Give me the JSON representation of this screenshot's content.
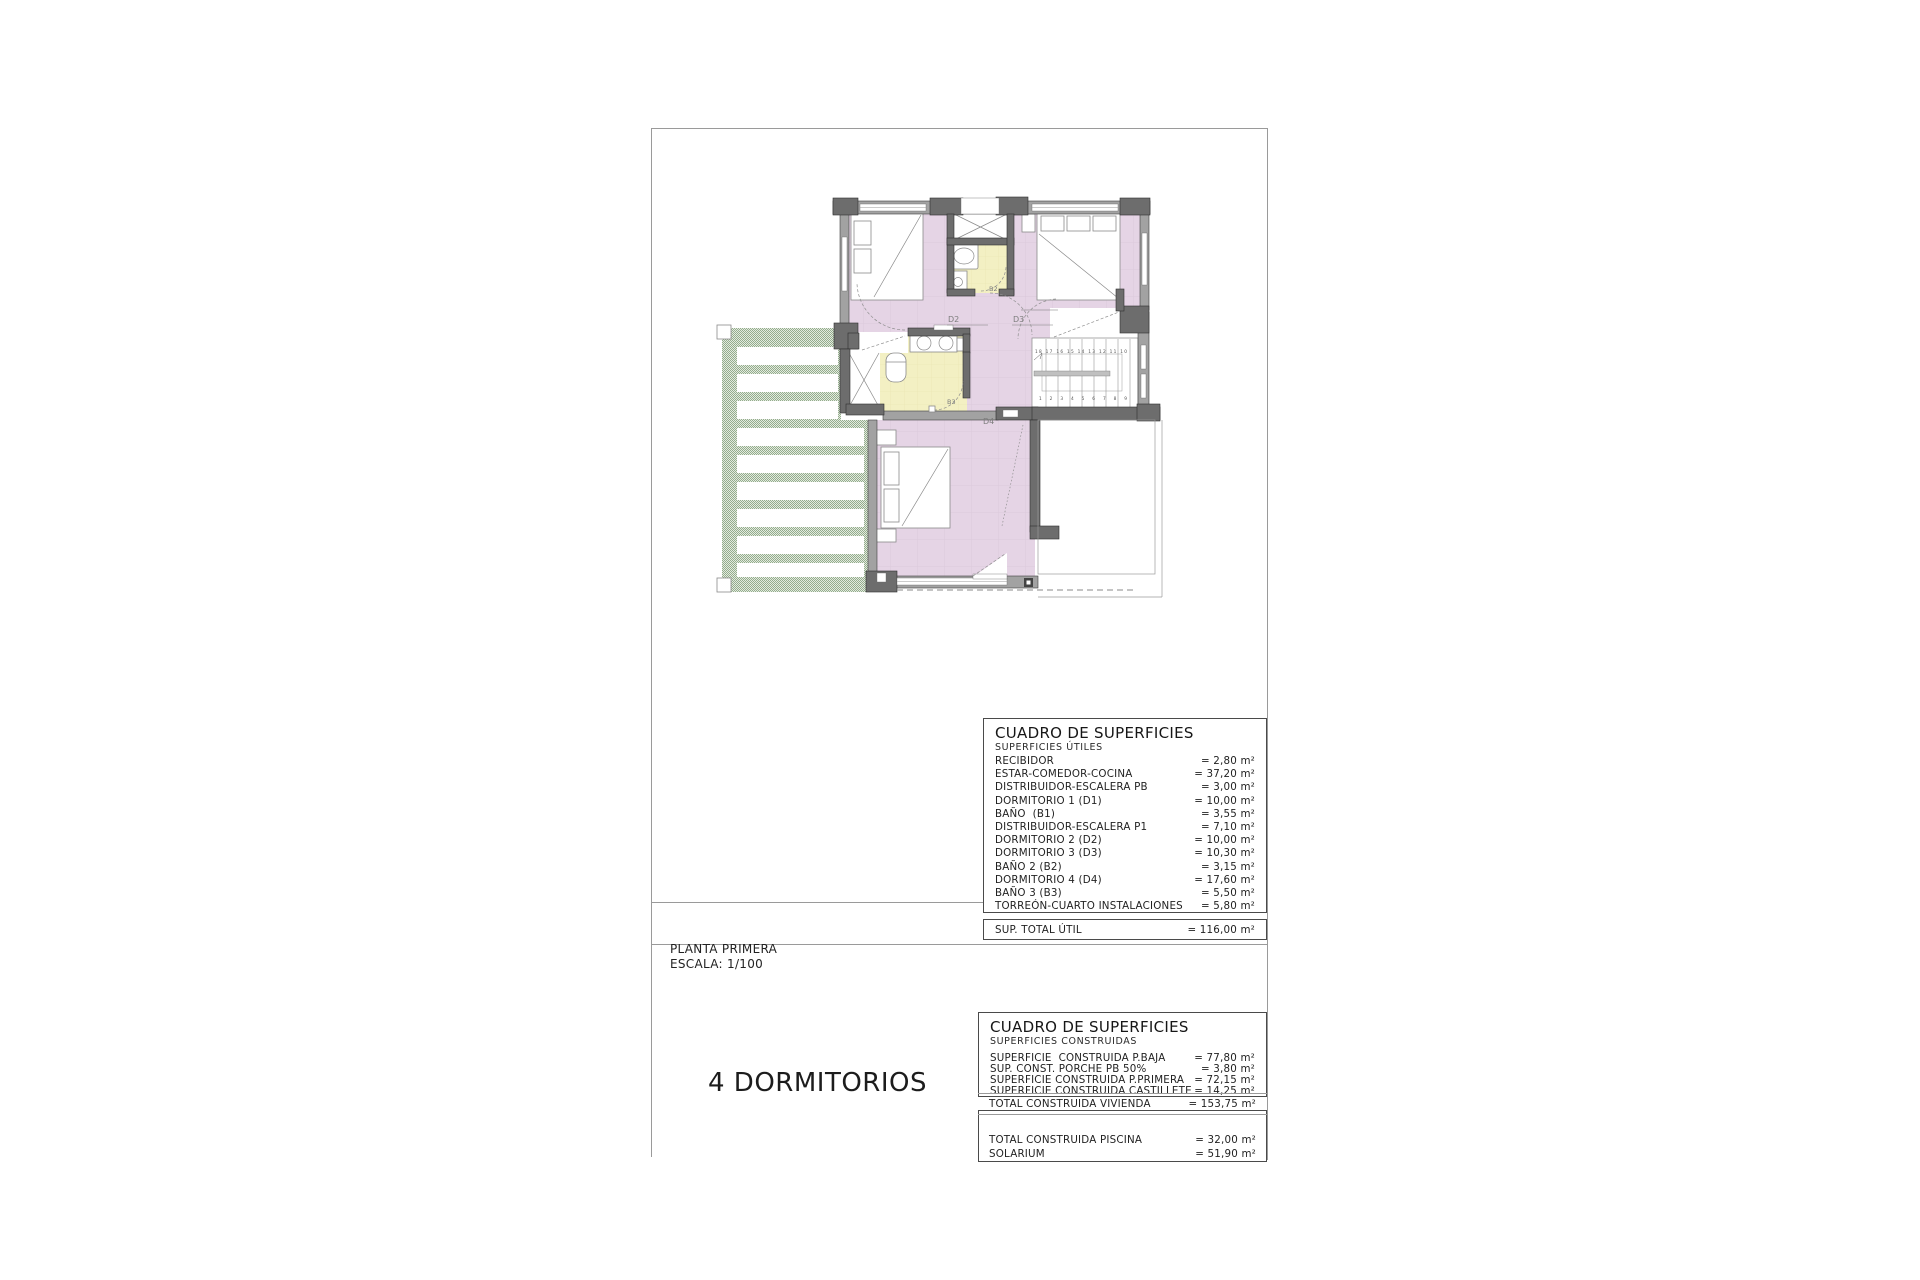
{
  "sheet": {
    "plan_title": "PLANTA PRIMERA",
    "plan_scale": "ESCALA: 1/100",
    "caption": "4 DORMITORIOS"
  },
  "tables": {
    "utiles": {
      "title": "CUADRO DE SUPERFICIES",
      "subtitle": "SUPERFICIES ÚTILES",
      "rows": [
        {
          "label": "RECIBIDOR",
          "value": "= 2,80 m²"
        },
        {
          "label": "ESTAR-COMEDOR-COCINA",
          "value": "= 37,20 m²"
        },
        {
          "label": "DISTRIBUIDOR-ESCALERA PB",
          "value": "= 3,00 m²"
        },
        {
          "label": "DORMITORIO 1 (D1)",
          "value": "= 10,00 m²"
        },
        {
          "label": "BAÑO  (B1)",
          "value": "= 3,55 m²"
        },
        {
          "label": "DISTRIBUIDOR-ESCALERA P1",
          "value": "= 7,10 m²"
        },
        {
          "label": "DORMITORIO 2 (D2)",
          "value": "= 10,00 m²"
        },
        {
          "label": "DORMITORIO 3 (D3)",
          "value": "= 10,30 m²"
        },
        {
          "label": "BAÑO 2 (B2)",
          "value": "= 3,15 m²"
        },
        {
          "label": "DORMITORIO 4 (D4)",
          "value": "= 17,60 m²"
        },
        {
          "label": "BAÑO 3 (B3)",
          "value": "= 5,50 m²"
        },
        {
          "label": "TORREÓN-CUARTO INSTALACIONES",
          "value": "= 5,80 m²"
        }
      ],
      "total": {
        "label": "SUP. TOTAL ÚTIL",
        "value": "= 116,00 m²"
      }
    },
    "construidas": {
      "title": "CUADRO DE SUPERFICIES",
      "subtitle": "SUPERFICIES CONSTRUIDAS",
      "rows": [
        {
          "label": "SUPERFICIE  CONSTRUIDA P.BAJA",
          "value": "= 77,80 m²"
        },
        {
          "label": "SUP. CONST. PORCHE PB 50%",
          "value": "= 3,80 m²"
        },
        {
          "label": "SUPERFICIE CONSTRUIDA P.PRIMERA",
          "value": "= 72,15 m²"
        },
        {
          "label": "SUPERFICIE CONSTRUIDA CASTILLETE",
          "value": "= 14,25 m²"
        }
      ],
      "total": {
        "label": "TOTAL CONSTRUIDA VIVIENDA",
        "value": "= 153,75 m²"
      },
      "extra_rows": [
        {
          "label": "TOTAL CONSTRUIDA PISCINA",
          "value": "= 32,00 m²"
        },
        {
          "label": "SOLARIUM",
          "value": "= 51,90 m²"
        }
      ]
    }
  },
  "plan": {
    "labels": {
      "d2": "D2",
      "d3": "D3",
      "d4": "D4",
      "b2": "B2",
      "b3": "B3"
    },
    "stairs": {
      "upper": "18 17 16 15 14 13 12 11 10",
      "lower": "1 2 3 4 5 6 7 8 9"
    },
    "colors": {
      "room": "#e5d4e5",
      "bath": "#f3f0c3",
      "wall": "#a2a2a2",
      "pillar": "#6d6d6d",
      "pergola-dark": "#94ac8d",
      "pergola-light": "#e3ebdf"
    }
  }
}
